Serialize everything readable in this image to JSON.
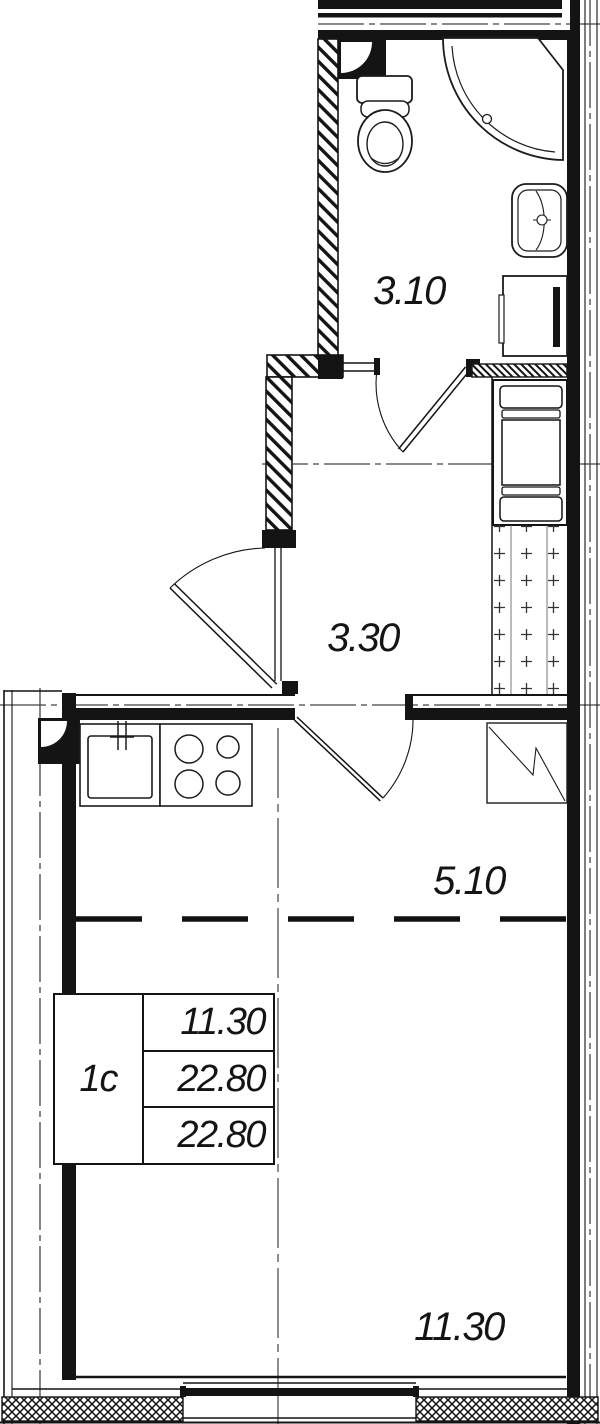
{
  "plan": {
    "labels": {
      "bathroom": "3.10",
      "hallway": "3.30",
      "kitchen": "5.10",
      "living": "11.30"
    },
    "info_table": {
      "type": "1с",
      "rows": [
        "11.30",
        "22.80",
        "22.80"
      ]
    },
    "colors": {
      "line": "#141414",
      "axis": "#444444",
      "bg": "#ffffff"
    }
  }
}
